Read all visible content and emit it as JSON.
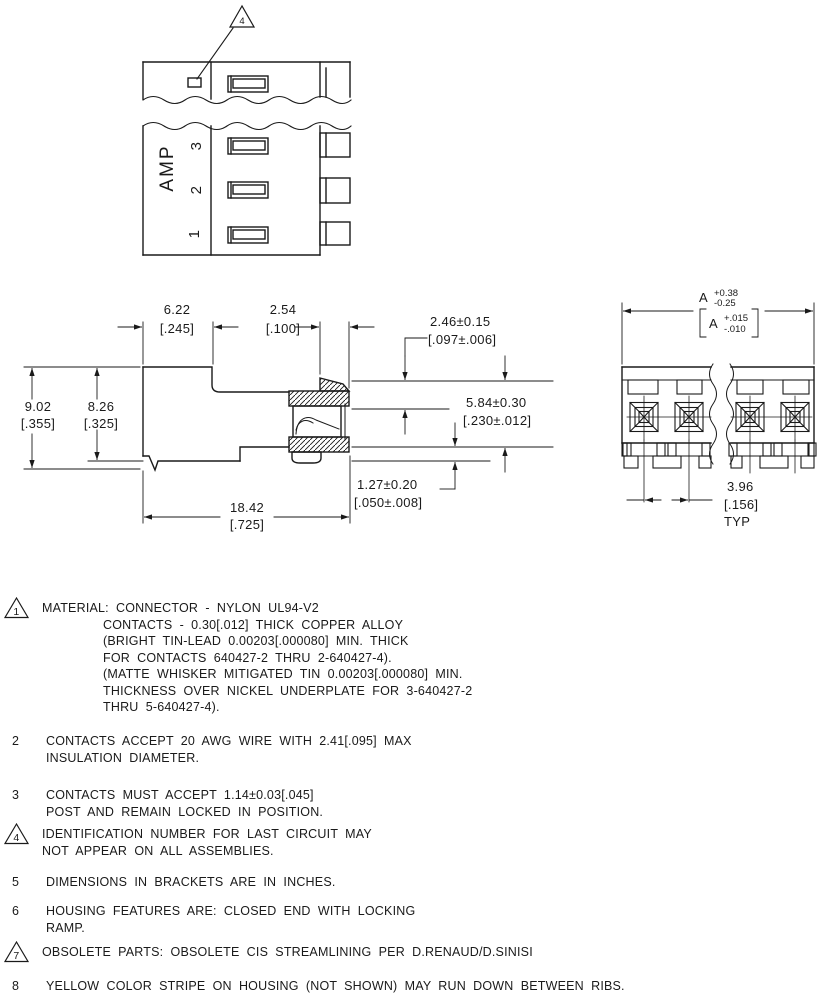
{
  "top_view": {
    "brand": "AMP",
    "circuits": [
      "1",
      "2",
      "3"
    ],
    "callout": "4"
  },
  "side_view": {
    "dim_622": {
      "mm": "6.22",
      "in": "[.245]"
    },
    "dim_254": {
      "mm": "2.54",
      "in": "[.100]"
    },
    "dim_246": {
      "mm": "2.46±0.15",
      "in": "[.097±.006]"
    },
    "dim_902": {
      "mm": "9.02",
      "in": "[.355]"
    },
    "dim_826": {
      "mm": "8.26",
      "in": "[.325]"
    },
    "dim_584": {
      "mm": "5.84±0.30",
      "in": "[.230±.012]"
    },
    "dim_127": {
      "mm": "1.27±0.20",
      "in": "[.050±.008]"
    },
    "dim_1842": {
      "mm": "18.42",
      "in": "[.725]"
    }
  },
  "front_view": {
    "dim_a_mm": {
      "label": "A",
      "plus": "+0.38",
      "minus": "-0.25"
    },
    "dim_a_in": {
      "label": "A",
      "plus": "+.015",
      "minus": "-.010"
    },
    "dim_pitch": {
      "mm": "3.96",
      "in": "[.156]",
      "qual": "TYP"
    }
  },
  "notes": [
    {
      "marker": "1",
      "flagged": true,
      "lines": [
        "MATERIAL: CONNECTOR - NYLON UL94-V2",
        "CONTACTS - 0.30[.012] THICK COPPER ALLOY",
        "(BRIGHT TIN-LEAD 0.00203[.000080] MIN. THICK",
        "FOR CONTACTS 640427-2 THRU 2-640427-4).",
        "(MATTE WHISKER MITIGATED TIN 0.00203[.000080] MIN.",
        "THICKNESS OVER NICKEL UNDERPLATE FOR 3-640427-2",
        "THRU 5-640427-4)."
      ]
    },
    {
      "marker": "2",
      "flagged": false,
      "lines": [
        "CONTACTS ACCEPT 20 AWG WIRE WITH 2.41[.095] MAX",
        "INSULATION DIAMETER."
      ]
    },
    {
      "marker": "3",
      "flagged": false,
      "lines": [
        "CONTACTS MUST ACCEPT 1.14±0.03[.045]",
        "POST AND REMAIN LOCKED IN POSITION."
      ]
    },
    {
      "marker": "4",
      "flagged": true,
      "lines": [
        "IDENTIFICATION NUMBER FOR LAST CIRCUIT MAY",
        "NOT APPEAR ON ALL ASSEMBLIES."
      ]
    },
    {
      "marker": "5",
      "flagged": false,
      "lines": [
        "DIMENSIONS IN BRACKETS ARE IN INCHES."
      ]
    },
    {
      "marker": "6",
      "flagged": false,
      "lines": [
        "HOUSING FEATURES ARE: CLOSED END WITH LOCKING",
        "RAMP."
      ]
    },
    {
      "marker": "7",
      "flagged": true,
      "lines": [
        "OBSOLETE PARTS: OBSOLETE CIS STREAMLINING PER D.RENAUD/D.SINISI"
      ]
    },
    {
      "marker": "8",
      "flagged": false,
      "lines": [
        "YELLOW COLOR STRIPE ON HOUSING (NOT SHOWN) MAY RUN DOWN BETWEEN RIBS."
      ]
    }
  ],
  "colors": {
    "line": "#1a1a1a",
    "background": "#ffffff"
  }
}
